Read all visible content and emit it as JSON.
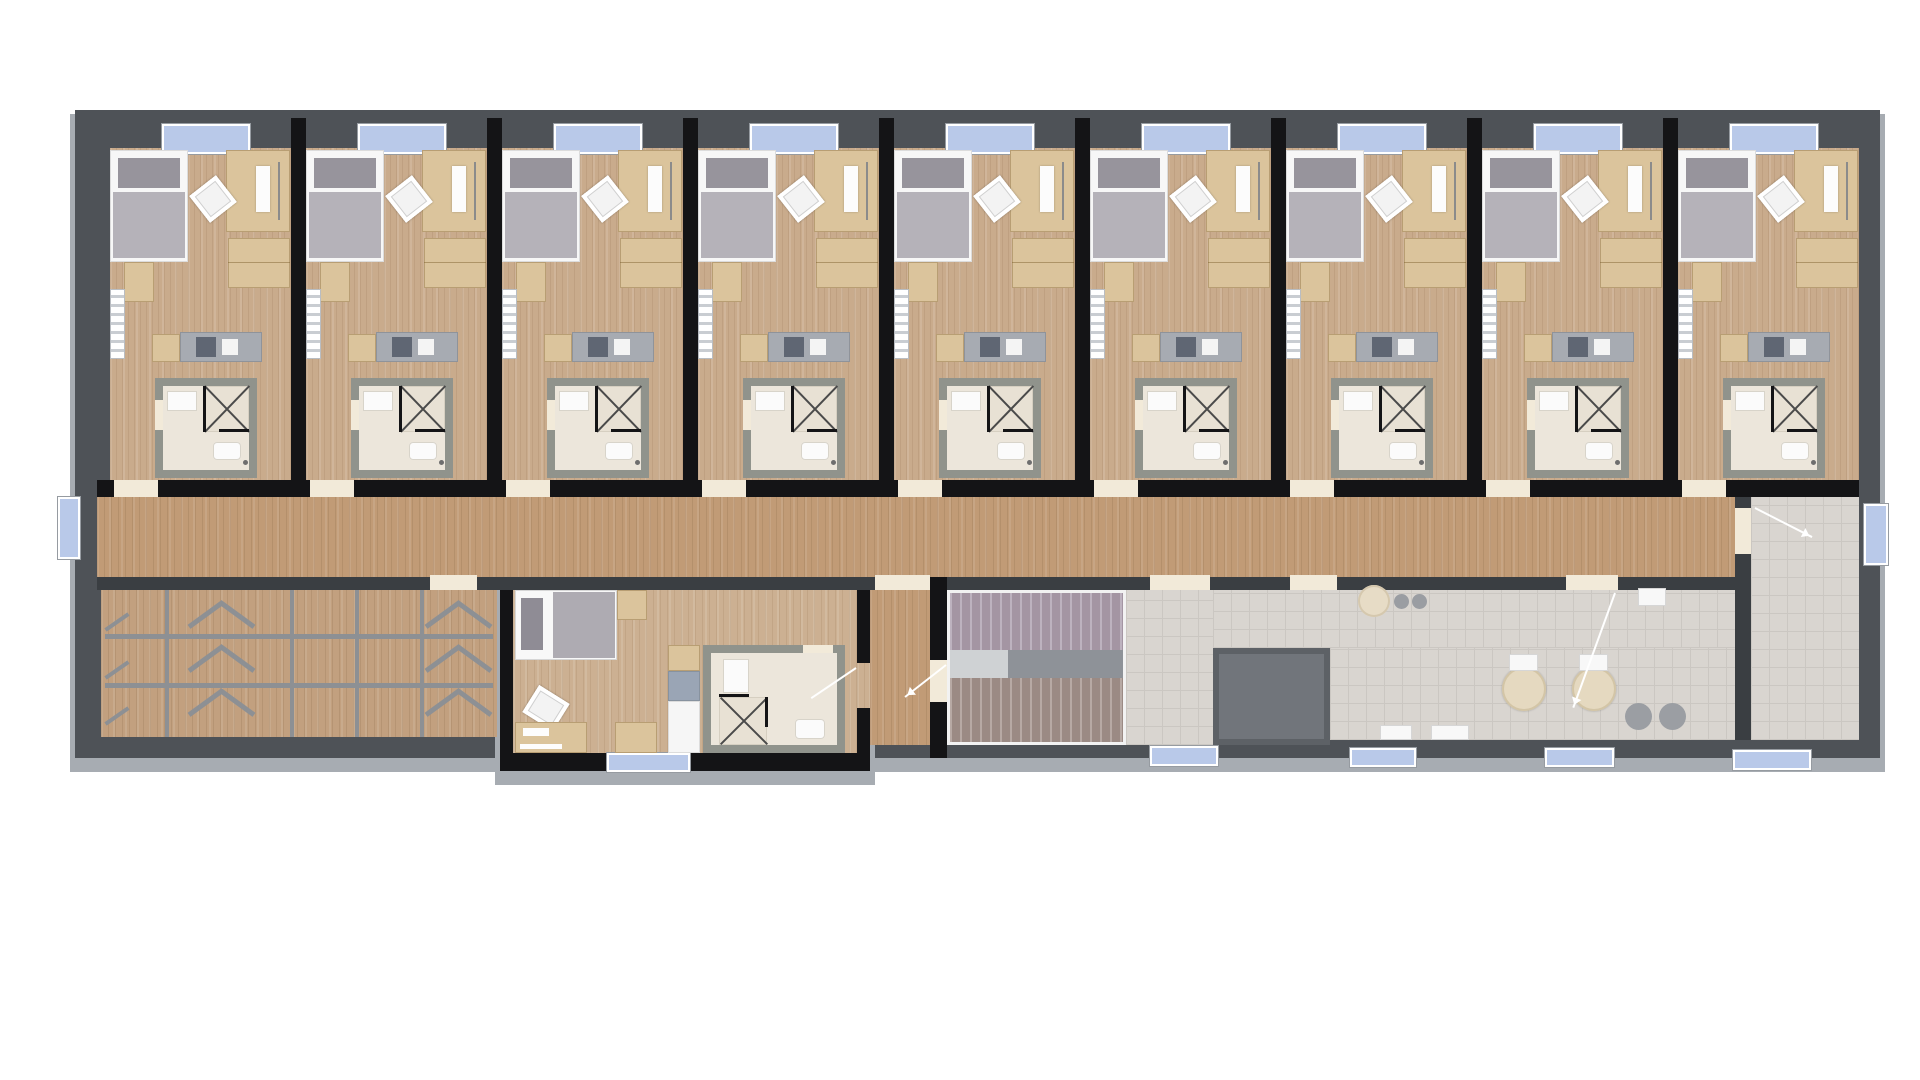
{
  "meta": {
    "type": "architectural floor plan rendering",
    "view": "top-down",
    "building": "residence floor with 9 identical guest rooms, central corridor, storage room, staff apartment, stairwell, elevator shaft and common room"
  },
  "colors": {
    "wall-black": "#141416",
    "wall-dark": "#4e5257",
    "wall-mid": "#3a3e42",
    "apron": "#a7acb2",
    "wood-room": "#c9ab8c",
    "wood-corridor": "#c19b76",
    "wood-storage": "#c2a07f",
    "wood-apartment": "#ccb092",
    "tile": "#d9d5d0",
    "tile-line": "#cbc7c2",
    "tan": "#dbc49c",
    "window-blue": "#b9c9e9",
    "threshold": "#f2ead9",
    "bath-wall": "#90938c",
    "bath-floor": "#ece6db",
    "rack": "#8d9094",
    "shaft": "#71757b",
    "stair-upper": "#a495a3",
    "stair-lower": "#9b8a84",
    "bed-pillow": "#97949c",
    "bed-blanket": "#b5b2b9"
  },
  "floor_plan": {
    "guest_rooms": {
      "count": 9,
      "rooms": [
        {
          "id": "room-1"
        },
        {
          "id": "room-2"
        },
        {
          "id": "room-3"
        },
        {
          "id": "room-4"
        },
        {
          "id": "room-5"
        },
        {
          "id": "room-6"
        },
        {
          "id": "room-7"
        },
        {
          "id": "room-8"
        },
        {
          "id": "room-9"
        }
      ],
      "furnishings_per_room": [
        "single bed",
        "desk with chair and laptop",
        "wardrobe",
        "side cabinet",
        "radiator",
        "kitchenette counter with hob and sink",
        "en-suite bathroom with sink, corner shower and toilet",
        "north facade window",
        "corridor entry door"
      ]
    },
    "corridor": {
      "orientation": "horizontal",
      "doors_to_rooms": 9,
      "west_window": true,
      "east_window": true
    },
    "storage_room": {
      "position": "south-west",
      "contents": "rack / locker rows with diagonal braces",
      "door_from_corridor": true
    },
    "apartment": {
      "position": "south-center, protruding south",
      "furnishings": [
        "double bed",
        "bedside cabinet",
        "desk with chair",
        "side table",
        "kitchenette with fridge",
        "bathroom with sink, shower and toilet",
        "south window"
      ]
    },
    "entry_hall": {
      "position": "between apartment and stairwell",
      "door_swings": 2
    },
    "stairwell": {
      "flights": 2,
      "landing": "west end with central stringer"
    },
    "stair_vestibule": {
      "south_exit": true
    },
    "elevator_shaft": {
      "position": "south of corridor, center-right"
    },
    "common_room": {
      "furnishings": [
        "counter with round sink and two hobs",
        "small white table",
        "two round tables with chairs",
        "two round poufs",
        "two white floor mats"
      ],
      "south_windows": 2,
      "doors_from_corridor": 2
    },
    "east_vestibule": {
      "position": "east end",
      "east_window": true,
      "south_entrance_door": true,
      "entry_arrow": true
    }
  }
}
